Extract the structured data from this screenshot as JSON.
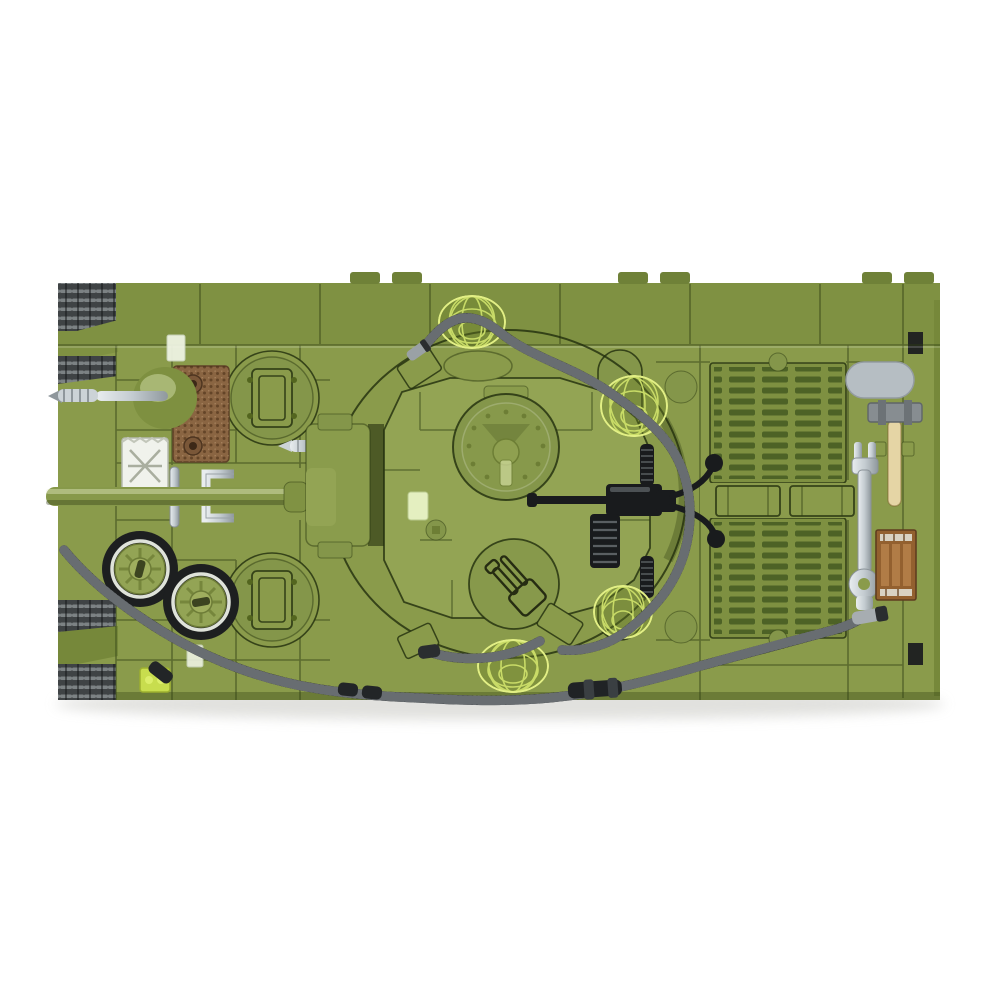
{
  "image": {
    "kind": "product-photo",
    "subject": "brick-built military tank construction-toy model, top-down view on white background",
    "background": "#ffffff"
  },
  "parts": [
    {
      "name": "hull",
      "description": "olive green brick hull, top view"
    },
    {
      "name": "tracks",
      "description": "dark grey treads visible at beveled left corners"
    },
    {
      "name": "turret",
      "description": "center turret with riveted commander hatch"
    },
    {
      "name": "gun-barrel",
      "description": "green main gun pointing left"
    },
    {
      "name": "machine-gun",
      "description": "black AA machine gun with spade grips on turret"
    },
    {
      "name": "engine-grilles",
      "description": "two louvered engine deck grilles on right"
    },
    {
      "name": "radiator-plate",
      "description": "brown textured grille plate, front deck"
    },
    {
      "name": "jerry-can",
      "description": "white fuel can"
    },
    {
      "name": "spare-wheels",
      "description": "two black-tired road wheels with green hubs"
    },
    {
      "name": "tow-cable",
      "description": "black braided cable looping around deck"
    },
    {
      "name": "camo-net-domes",
      "description": "four lime wireframe net domes"
    },
    {
      "name": "hammer",
      "description": "sledgehammer with tan handle, rear deck"
    },
    {
      "name": "wrench",
      "description": "silver wrench, rear deck"
    },
    {
      "name": "crate-tile",
      "description": "printed brown crate tile"
    },
    {
      "name": "fender-oval",
      "description": "light grey oval tile"
    },
    {
      "name": "auger",
      "description": "silver screw piece at front left"
    },
    {
      "name": "porthole-hatches",
      "description": "round hatches with rectangular covers"
    },
    {
      "name": "printed-hatch",
      "description": "round hatch printed with tool outlines"
    }
  ],
  "colors": {
    "bg": "#ffffff",
    "hull": "#8a9b4b",
    "hullLight": "#93a454",
    "hullDark": "#76883a",
    "band": "#7f9142",
    "slot": "#4d6226",
    "seam": "rgba(45,60,18,0.5)",
    "seamDark": "rgba(33,45,12,0.8)",
    "track": "#3f4345",
    "trackLight": "#7c8284",
    "tire": "#1d1f20",
    "whitewall": "#dfe3da",
    "hubGreen": "#93a455",
    "brown": "#8a6542",
    "white": "#f0f2ec",
    "grayPill": "#b6bec3",
    "hammerHead": "#878d91",
    "handleTan": "#e5d5a5",
    "silver": "#ccd3d7",
    "silverDark": "#8f979c",
    "cable": "#1b1d1f",
    "cableRib": "#71777a",
    "mesh": "#cde06a",
    "meshRim": "#e2ef85",
    "mg": "#191b1d",
    "crateBrown": "#93602f",
    "cratePlank": "#b17c46",
    "transGreen": "#e4efc0",
    "limeBright": "#c8dd4e"
  }
}
